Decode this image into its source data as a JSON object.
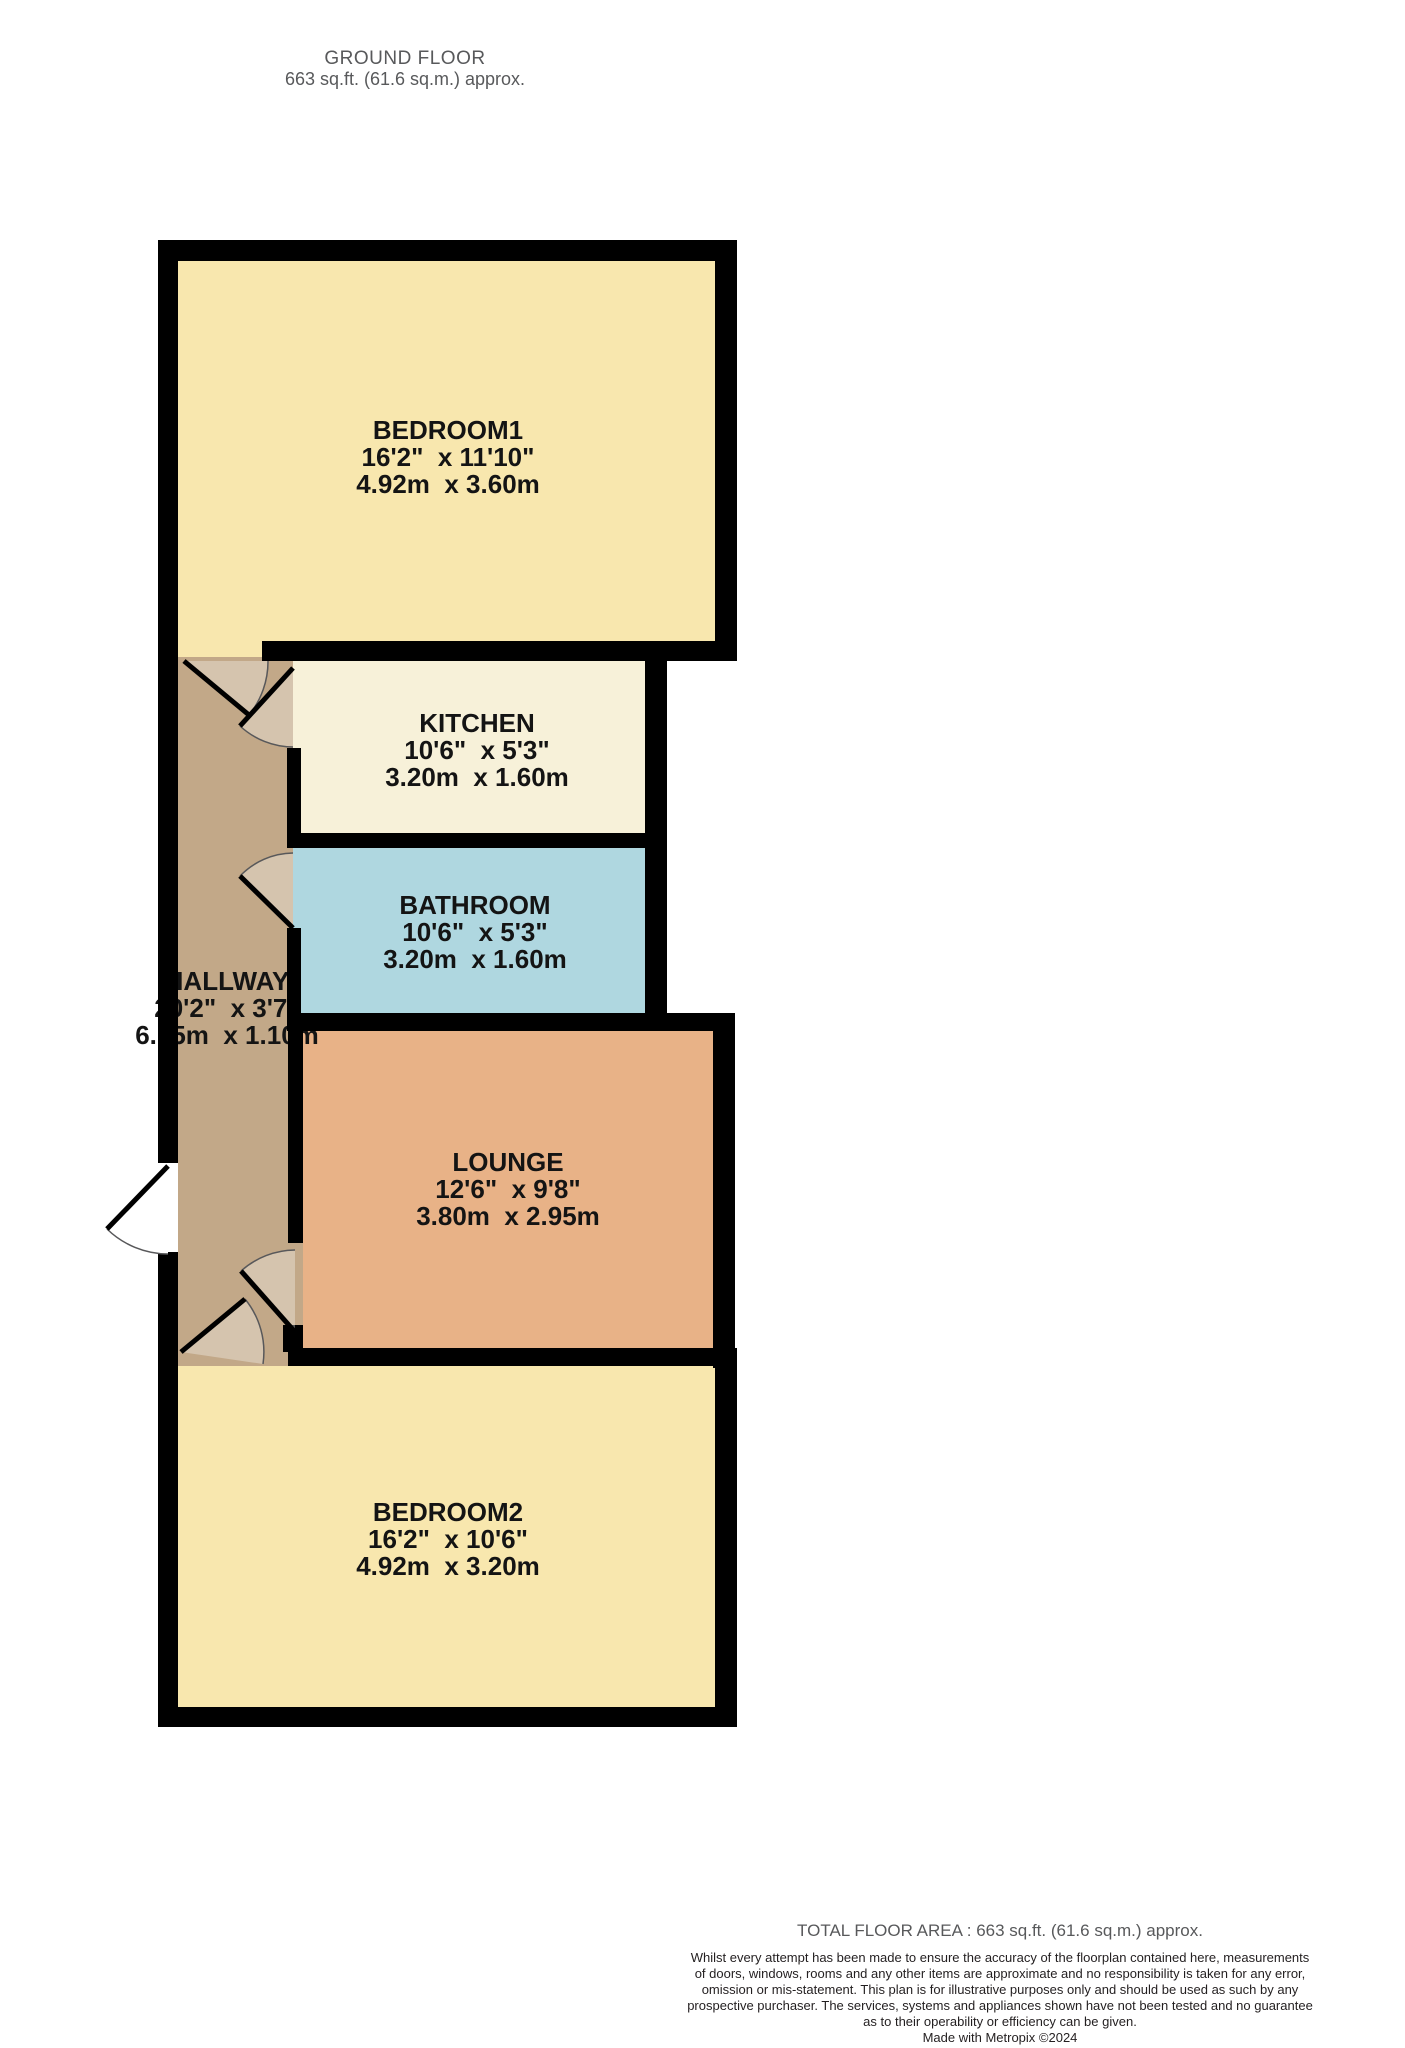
{
  "header": {
    "title": "GROUND FLOOR",
    "subtitle": "663 sq.ft. (61.6 sq.m.) approx."
  },
  "rooms": [
    {
      "id": "bedroom1",
      "name": "BEDROOM1",
      "imperial": "16'2\"  x 11'10\"",
      "metric": "4.92m  x 3.60m",
      "color": "#f8e7ae"
    },
    {
      "id": "kitchen",
      "name": "KITCHEN",
      "imperial": "10'6\"  x 5'3\"",
      "metric": "3.20m  x 1.60m",
      "color": "#f7f1d9"
    },
    {
      "id": "bathroom",
      "name": "BATHROOM",
      "imperial": "10'6\"  x 5'3\"",
      "metric": "3.20m  x 1.60m",
      "color": "#afd7e0"
    },
    {
      "id": "hallway",
      "name": "HALLWAY",
      "imperial": "20'2\"  x 3'7\"",
      "metric": "6.15m  x 1.10m",
      "color": "#c2a888"
    },
    {
      "id": "lounge",
      "name": "LOUNGE",
      "imperial": "12'6\"  x 9'8\"",
      "metric": "3.80m  x 2.95m",
      "color": "#e8b287"
    },
    {
      "id": "bedroom2",
      "name": "BEDROOM2",
      "imperial": "16'2\"  x 10'6\"",
      "metric": "4.92m  x 3.20m",
      "color": "#f8e7ae"
    }
  ],
  "colors": {
    "wall": "#000000",
    "door_arc": "#58585a",
    "door_leaf": "#000000",
    "background": "#ffffff"
  },
  "footer": {
    "total_area": "TOTAL FLOOR AREA : 663 sq.ft. (61.6 sq.m.) approx.",
    "disclaimer": "Whilst every attempt has been made to ensure the accuracy of the floorplan contained here, measurements\nof doors, windows, rooms and any other items are approximate and no responsibility is taken for any error,\nomission or mis-statement. This plan is for illustrative purposes only and should be used as such by any\nprospective purchaser. The services, systems and appliances shown have not been tested and no guarantee\nas to their operability or efficiency can be given.",
    "credit": "Made with Metropix ©2024"
  }
}
